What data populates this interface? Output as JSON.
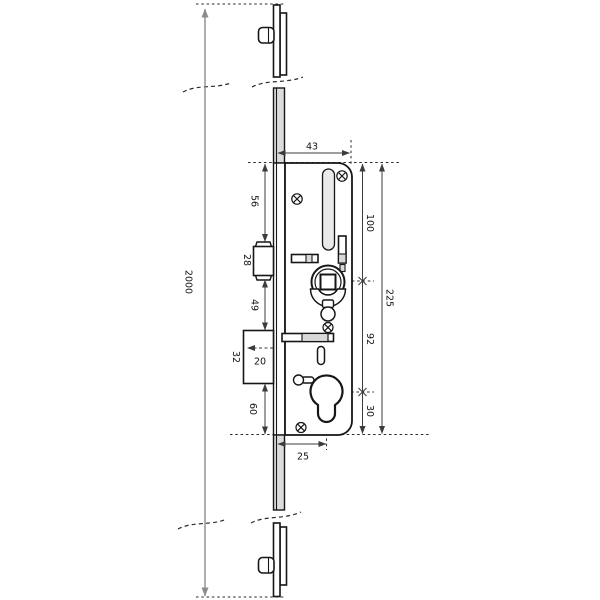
{
  "drawing": {
    "type": "technical-dimension-drawing",
    "subject_labels": {
      "overall_length": "2000",
      "case_width": "43",
      "top_to_latch": "56",
      "latch_height": "28",
      "latch_to_bolt": "49",
      "bolt_height": "32",
      "bolt_throw": "20",
      "bolt_to_bottom": "60",
      "top_to_spindle": "100",
      "spindle_to_cylinder": "92",
      "cylinder_to_bottom": "30",
      "case_height": "225",
      "cylinder_offset": "25"
    },
    "colors": {
      "line": "#161616",
      "dimension": "#3c3c3c",
      "overall_dimension": "#8c8c8c",
      "slot_fill": "#e9e9e9",
      "segment_fill": "#d9d9d9",
      "faceplate_fill": "#dcdcdc",
      "background": "#ffffff"
    }
  }
}
